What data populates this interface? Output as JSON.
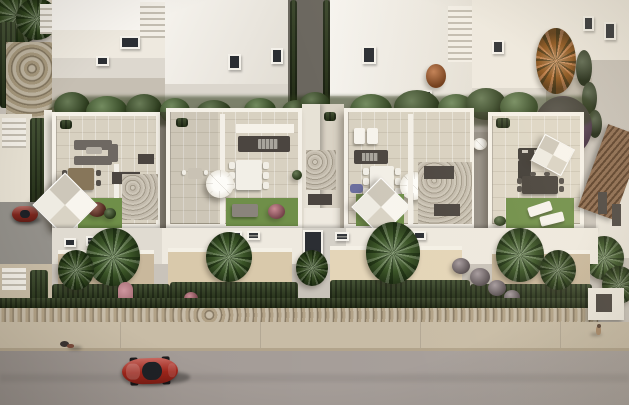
{
  "scene": {
    "type": "architectural-aerial-render",
    "subject": "aerial 3D rendering of a white Mediterranean townhouse development with rooftop terraces (solariums), private gardens with palm trees, a perimeter stone wall, sidewalk and street with a red car and two pedestrians",
    "objects": [
      "background-houses",
      "rooftop-terraces",
      "shade-sails",
      "parasols",
      "outdoor-kitchens",
      "dining-sets",
      "lounge-sofas",
      "sun-loungers",
      "lawns",
      "palm-trees",
      "orange-autumn-tree",
      "purple-tree",
      "cypresses",
      "agave-bushes",
      "stone-walls",
      "hedges",
      "staircases",
      "sidewalk",
      "road",
      "red-car",
      "parked-red-car",
      "pedestrians",
      "neighbor-house-terracotta-roof"
    ]
  },
  "palette": {
    "white_wall": "#eee9df",
    "white_wall_shade": "#d7d2c8",
    "roof_floor": "#d8d1c1",
    "lawn_green": "#6f8f49",
    "tree_green": "#3e5627",
    "palm_green": "#4c6b33",
    "hedge_green": "#2f3e1e",
    "dark_hedge": "#283517",
    "orange_tree": "#c2681f",
    "orange_bush": "#b05a22",
    "purple_tree": "#6a4a67",
    "pink_flower": "#bb6a76",
    "lavender": "#6c6f9e",
    "agave": "#8d7f83",
    "stone_wall": "#b2a287",
    "stone_wall_dark": "#a5977c",
    "sidewalk": "#c8bca6",
    "road": "#a49c97",
    "driveway": "#93908a",
    "car_red": "#b5291d",
    "car_red_parked": "#8f2a20",
    "charcoal": "#4b4540",
    "terracotta_roof": "#7c5536",
    "decking": "#d9c9ab",
    "decking_light": "#e4d5b8",
    "decking_shade": "#c9b89c",
    "red_bush": "#7a3c2c",
    "cypress": "#2c3c1d",
    "sofa_gray": "#6e6862",
    "table_brown": "#87765a"
  }
}
